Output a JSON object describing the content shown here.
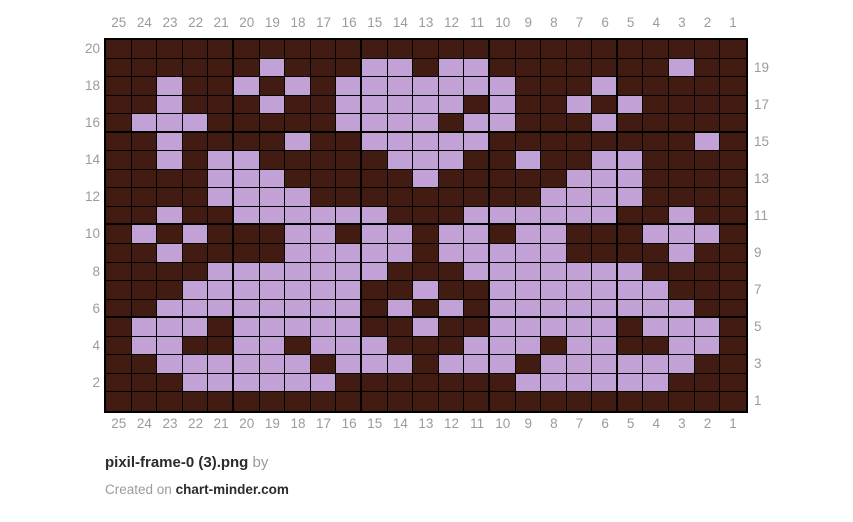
{
  "page": {
    "background": "#ffffff"
  },
  "chart_data": {
    "type": "heatmap",
    "title": "pixil-frame-0 (3).png",
    "subtitle": "two-color knitting pixel chart, 25 stitches x 20 rows",
    "num_cols": 25,
    "num_rows": 20,
    "grid_on": true,
    "col_labels": [
      "25",
      "24",
      "23",
      "22",
      "21",
      "20",
      "19",
      "18",
      "17",
      "16",
      "15",
      "14",
      "13",
      "12",
      "11",
      "10",
      "9",
      "8",
      "7",
      "6",
      "5",
      "4",
      "3",
      "2",
      "1"
    ],
    "left_row_labels": [
      "20",
      "18",
      "16",
      "14",
      "12",
      "10",
      "8",
      "6",
      "4",
      "2"
    ],
    "right_row_labels": [
      "19",
      "17",
      "15",
      "13",
      "11",
      "9",
      "7",
      "5",
      "3",
      "1"
    ],
    "cell_colors": {
      "0": "#421b12",
      "1": "#c2a2d6"
    },
    "color_meanings": {
      "0": "dark-brown background",
      "1": "lavender motif"
    },
    "grid_line_color": "#000000",
    "rows_top_to_bottom": [
      "0000000000000000000000000",
      "0000001000110110000000100",
      "0010010101111111000100000",
      "0010001001111101001010000",
      "0111000001111011000100000",
      "0010000100111110000000010",
      "0010110000011100100110000",
      "0000111000001000001110000",
      "0000111100000000011110000",
      "0010011111100011111100100",
      "0101000110110110110001110",
      "0010000111110111110000100",
      "0000111111100011111110000",
      "0001111111001001111111000",
      "0011111111010101111111100",
      "0111011111001001111101110",
      "0110011011100011101100110",
      "0011111101110111011111100",
      "0001111110000000111111000",
      "0000000000000000000000000"
    ]
  },
  "footer": {
    "title": "pixil-frame-0 (3).png",
    "by_label": "by",
    "created_prefix": "Created on",
    "site": "chart-minder.com"
  }
}
